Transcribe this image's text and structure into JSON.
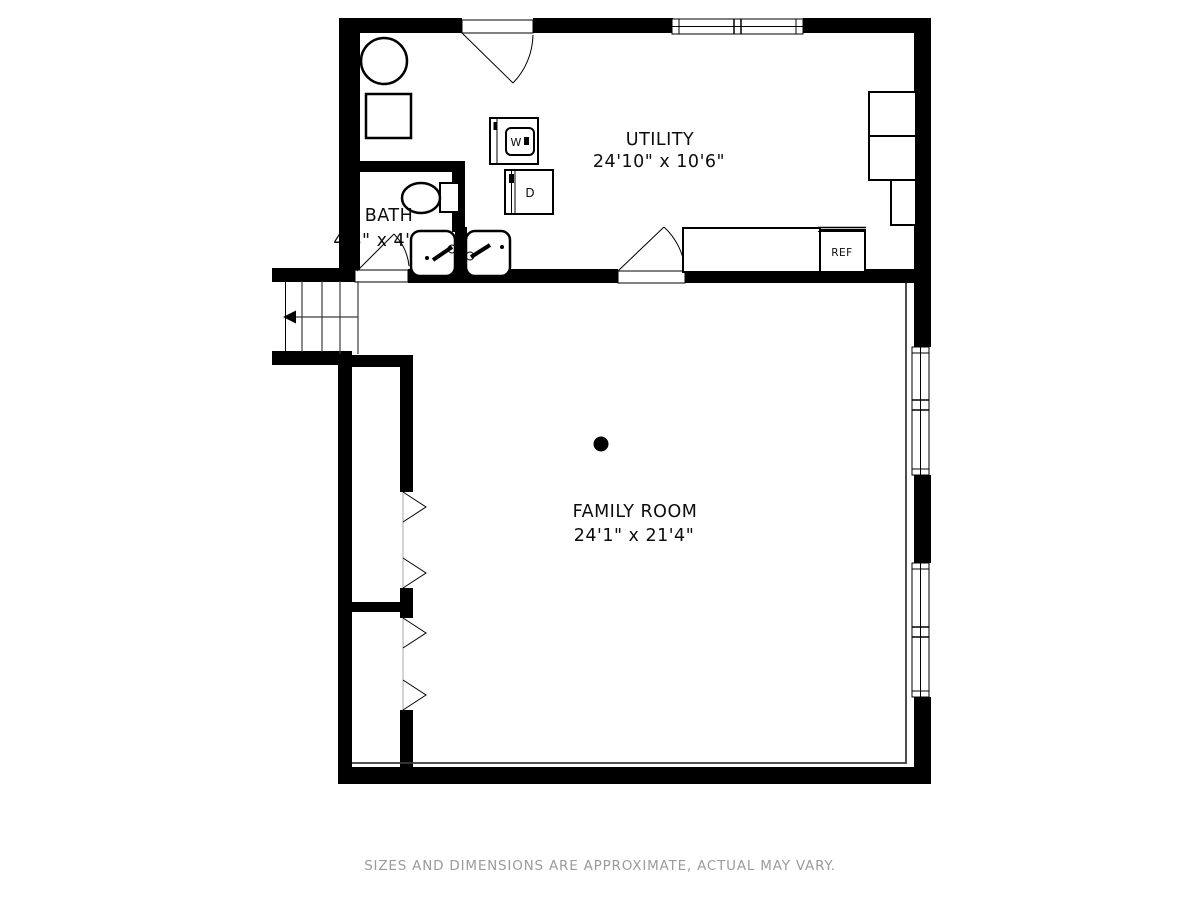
{
  "plan": {
    "rooms": {
      "utility": {
        "name": "UTILITY",
        "dimensions": "24'10\" x 10'6\""
      },
      "bath": {
        "name": "BATH",
        "dimensions": "4'8\" x 4'5\""
      },
      "family_room": {
        "name": "FAMILY ROOM",
        "dimensions": "24'1\" x 21'4\""
      }
    },
    "appliances": {
      "washer": "W",
      "dryer": "D",
      "refrigerator": "REF"
    },
    "footer_disclaimer": "SIZES AND DIMENSIONS ARE APPROXIMATE, ACTUAL MAY VARY.",
    "colors": {
      "walls": "#000000",
      "background": "#ffffff",
      "disclaimer_text": "#9b9b9b"
    }
  }
}
